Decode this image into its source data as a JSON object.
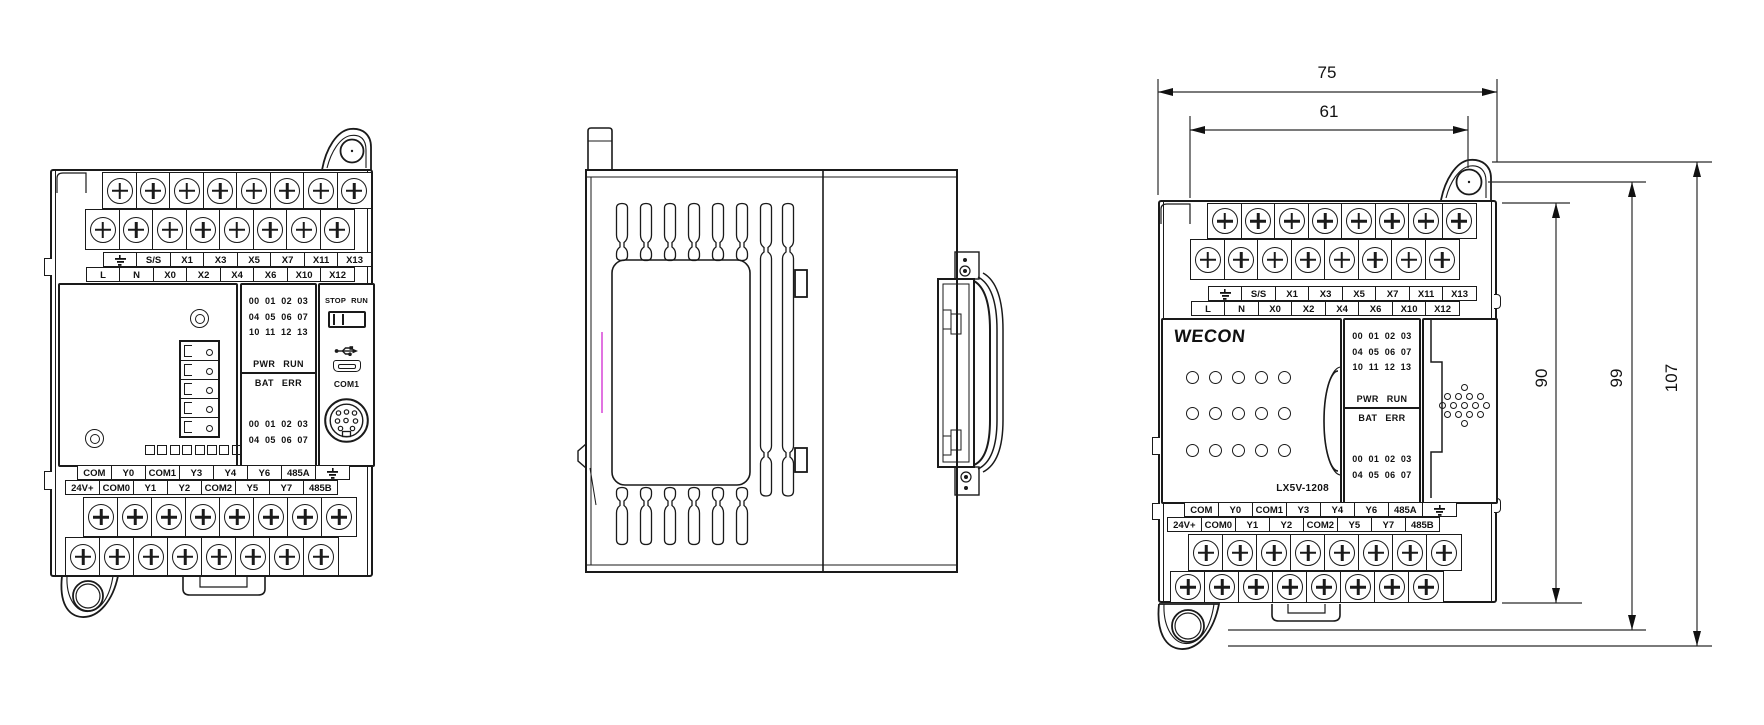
{
  "product": {
    "brand": "WECON",
    "model": "LX5V-1208"
  },
  "terminal_labels": {
    "top_row_upper": [
      {
        "icon": "earth-ground-icon"
      },
      "S/S",
      "X1",
      "X3",
      "X5",
      "X7",
      "X11",
      "X13"
    ],
    "top_row_lower": [
      "L",
      "N",
      "X0",
      "X2",
      "X4",
      "X6",
      "X10",
      "X12"
    ],
    "bottom_row_upper": [
      "COM",
      "Y0",
      "COM1",
      "Y3",
      "Y4",
      "Y6",
      "485A",
      {
        "icon": "earth-ground-icon"
      }
    ],
    "bottom_row_lower": [
      "24V+",
      "COM0",
      "Y1",
      "Y2",
      "COM2",
      "Y5",
      "Y7",
      "485B"
    ]
  },
  "indicator_panel": {
    "input_rows": [
      "00 01 02 03",
      "04 05 06 07",
      "10 11 12 13"
    ],
    "pwr_run_label": "PWR RUN",
    "bat_err_label": "BAT ERR",
    "output_rows": [
      "00 01 02 03",
      "04 05 06 07"
    ]
  },
  "controls": {
    "run_stop_label": "STOP RUN",
    "com1_label": "COM1"
  },
  "dimensions_mm": {
    "overall_width": "75",
    "mounting_hole_width": "61",
    "body_height": "90",
    "mounting_height": "99",
    "overall_height": "107"
  }
}
